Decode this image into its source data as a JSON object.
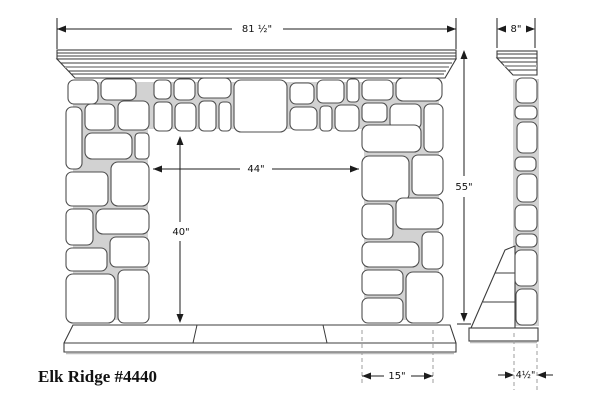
{
  "product": {
    "label": "Elk Ridge #4440"
  },
  "dims": {
    "overall_width": "81 ½\"",
    "mantel_depth": "8\"",
    "opening_width": "44\"",
    "opening_height": "40\"",
    "overall_height": "55\"",
    "leg_base_width": "15\"",
    "side_base_depth": "4½\""
  },
  "colors": {
    "line": "#2e2e2e",
    "stone_fill": "#ffffff",
    "mortar": "#d2d2d2",
    "dashed_line": "#9c9c9c",
    "background": "#ffffff"
  }
}
